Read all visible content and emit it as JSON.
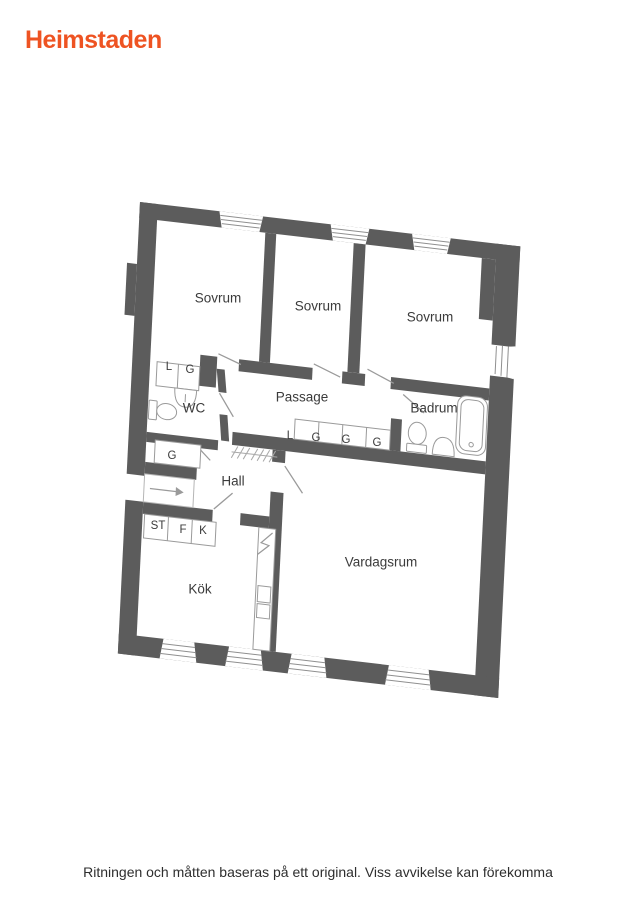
{
  "brand": {
    "name": "Heimstaden"
  },
  "colors": {
    "logo_orange": "#ee5322",
    "wall_gray": "#5c5c5c",
    "thin_line": "#9a9a9a"
  },
  "floorplan": {
    "room_labels": [
      "Sovrum",
      "Sovrum",
      "Sovrum",
      "Passage",
      "Badrum",
      "WC",
      "Hall",
      "Kök",
      "Vardagsrum"
    ],
    "fixture_labels": {
      "tl_closets": [
        "L",
        "G"
      ],
      "hall_closet": "G",
      "kitchen_units": [
        "ST",
        "F",
        "K"
      ],
      "passage_closets": [
        "L",
        "G",
        "G",
        "G"
      ]
    }
  },
  "footer": {
    "disclaimer": "Ritningen och måtten baseras på ett original. Viss avvikelse kan förekomma"
  }
}
